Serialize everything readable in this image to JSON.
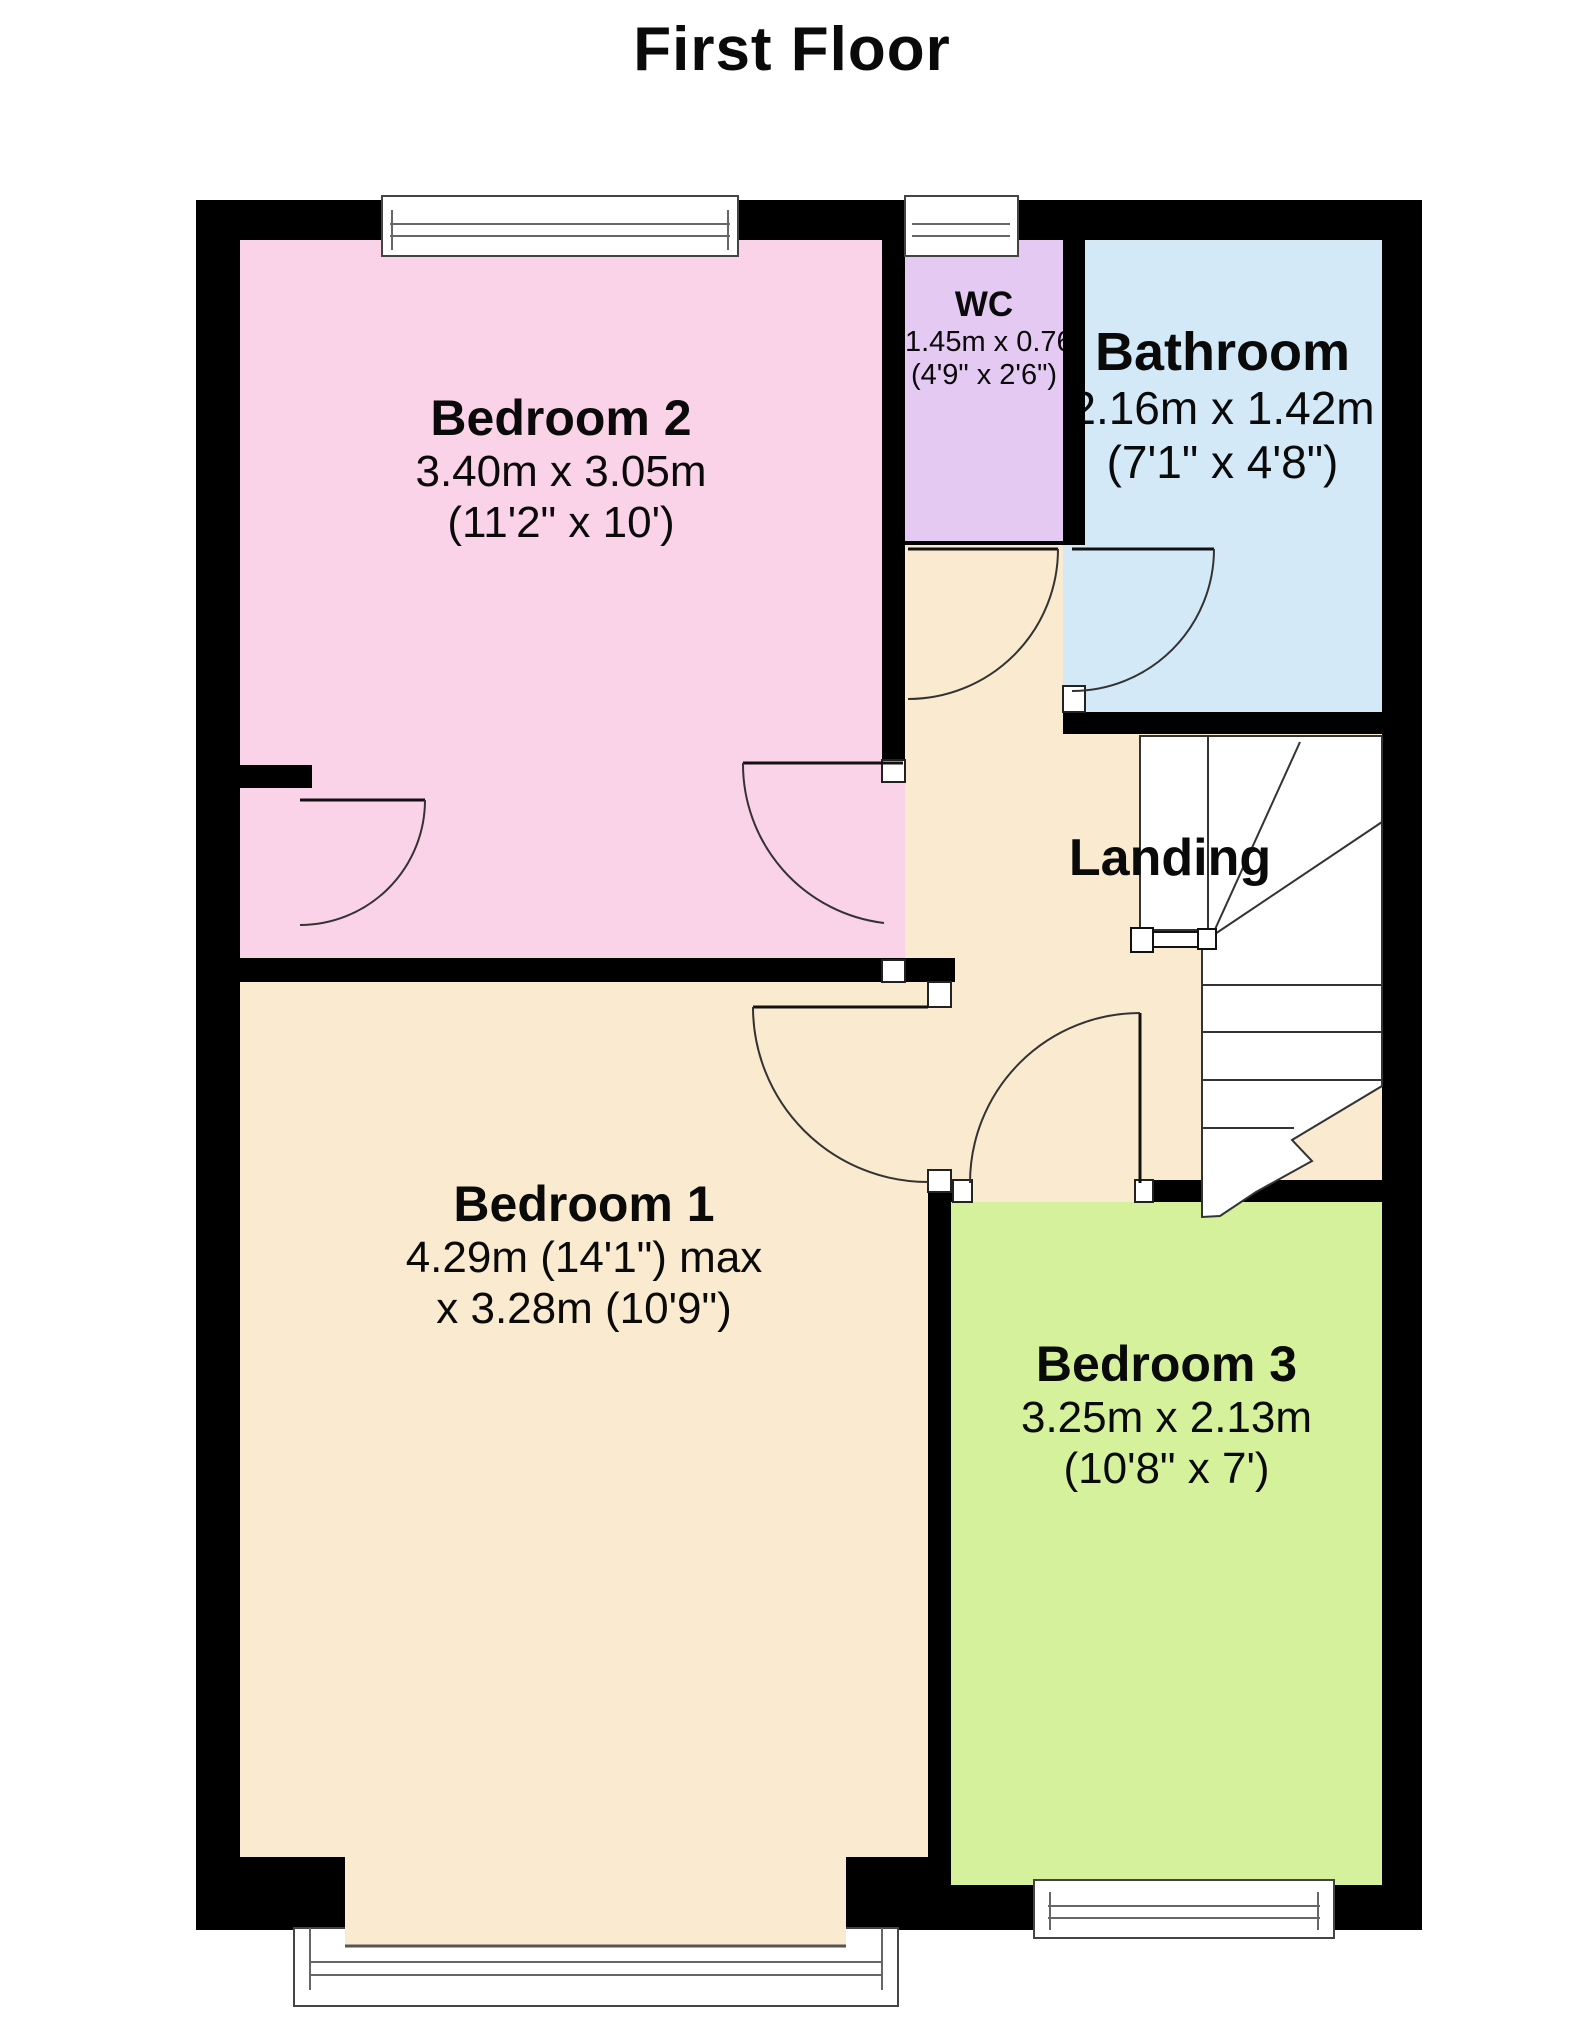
{
  "title": "First Floor",
  "rooms": {
    "bedroom2": {
      "name": "Bedroom 2",
      "metric": "3.40m x 3.05m",
      "imperial": "(11'2\" x 10')",
      "color": "#fbd3e9"
    },
    "wc": {
      "name": "WC",
      "metric": "1.45m x 0.76m",
      "imperial": "(4'9\" x 2'6\")",
      "color": "#e4c9f3"
    },
    "bathroom": {
      "name": "Bathroom",
      "metric": "2.16m x 1.42m",
      "imperial": "(7'1\" x 4'8\")",
      "color": "#d4e9f7"
    },
    "landing": {
      "name": "Landing",
      "color": "#faeacf"
    },
    "bedroom1": {
      "name": "Bedroom 1",
      "metric": "4.29m (14'1\") max",
      "imperial": "x 3.28m (10'9\")",
      "color": "#faeacf"
    },
    "bedroom3": {
      "name": "Bedroom 3",
      "metric": "3.25m x 2.13m",
      "imperial": "(10'8\" x 7')",
      "color": "#d6f19c"
    }
  },
  "wall_color": "#000000"
}
